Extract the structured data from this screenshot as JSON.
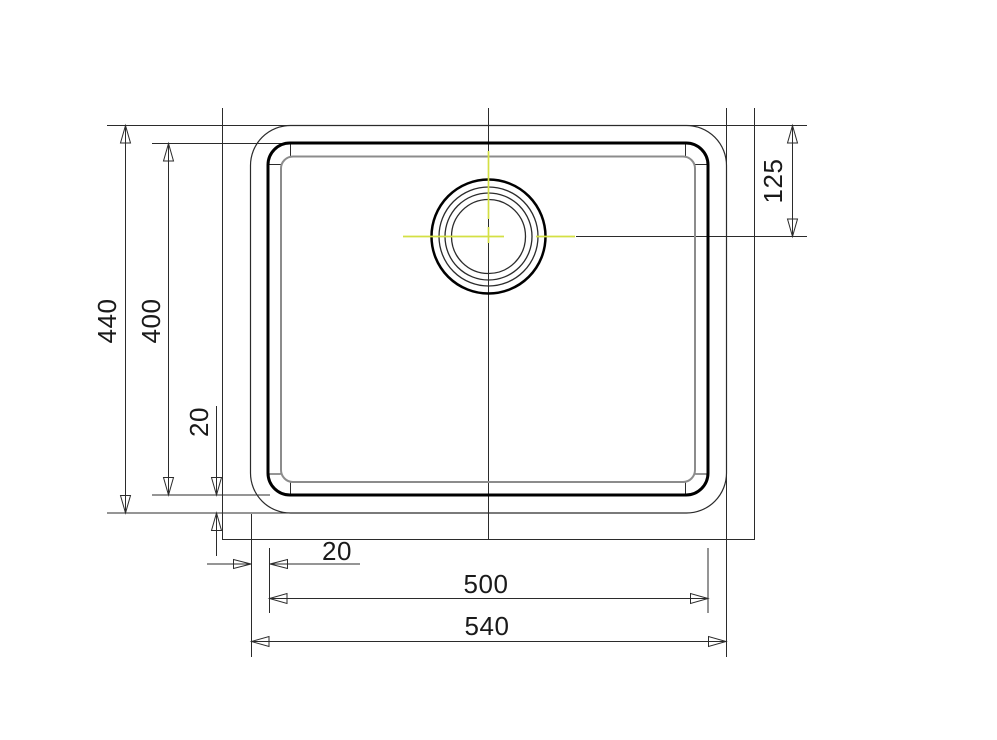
{
  "drawing": {
    "type": "technical-dimension-drawing",
    "subject": "undermount sink bowl, top view with drain",
    "dimensions": {
      "outer_height": "440",
      "bowl_height": "400",
      "bowl_bottom_offset": "20",
      "drain_center_from_top": "125",
      "bowl_left_offset": "20",
      "bowl_width": "500",
      "outer_width": "540"
    },
    "colors": {
      "line": "#2b2b2b",
      "bowl_outline": "#000000",
      "bowl_floor": "#8c8c8c",
      "centermark": "#d4e044",
      "text": "#1a1a1a",
      "background": "#ffffff"
    }
  }
}
